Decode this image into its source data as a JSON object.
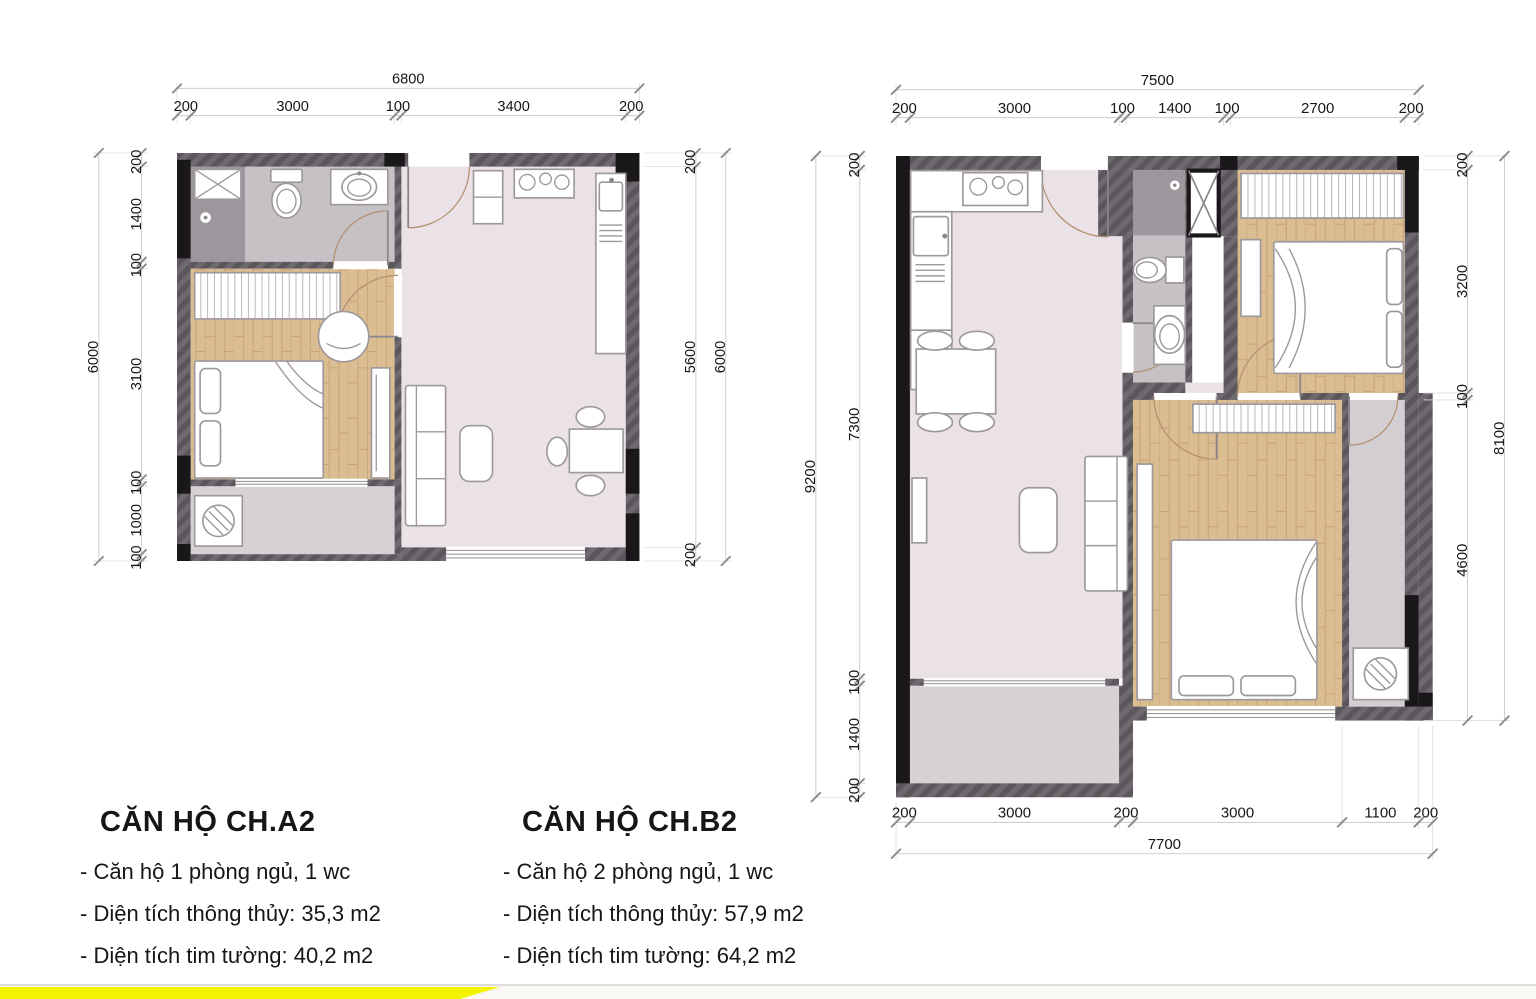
{
  "plans": [
    {
      "name": "CH.A2",
      "title": "CĂN HỘ CH.A2",
      "specs": [
        "- Căn hộ 1 phòng ngủ, 1 wc",
        "- Diện tích thông thủy: 35,3 m2",
        "- Diện tích tim tường: 40,2 m2"
      ],
      "dims": {
        "top": {
          "total": "6800",
          "segments": [
            "200",
            "3000",
            "100",
            "3400",
            "200"
          ]
        },
        "left": {
          "total": "6000",
          "segments": [
            "200",
            "1400",
            "100",
            "3100",
            "100",
            "1000",
            "100"
          ]
        },
        "right": {
          "total": "6000",
          "segments": [
            "200",
            "5600",
            "200"
          ]
        }
      }
    },
    {
      "name": "CH.B2",
      "title": "CĂN HỘ CH.B2",
      "specs": [
        "- Căn hộ 2 phòng ngủ, 1 wc",
        "- Diện tích thông thủy: 57,9 m2",
        "- Diện tích tim tường: 64,2 m2"
      ],
      "dims": {
        "top": {
          "total": "7500",
          "segments": [
            "200",
            "3000",
            "100",
            "1400",
            "100",
            "2700",
            "200"
          ]
        },
        "left": {
          "total": "9200",
          "segments": [
            "200",
            "7300",
            "100",
            "1400",
            "200"
          ]
        },
        "right": {
          "total": "8100",
          "segments": [
            "200",
            "3200",
            "100",
            "4600"
          ]
        },
        "bottom": {
          "total": "7700",
          "segments": [
            "200",
            "3000",
            "200",
            "3000",
            "1100",
            "200"
          ]
        }
      }
    }
  ],
  "colors": {
    "wall_hatch": "#6e696e",
    "column_black": "#191719",
    "wood_floor": "#dbbd92",
    "living_floor": "#eae2e6",
    "wet_floor": "#c6c1c5",
    "shower_floor": "#9d979d",
    "balcony_floor": "#d5d1d4",
    "accent_yellow": "#f2f202"
  }
}
